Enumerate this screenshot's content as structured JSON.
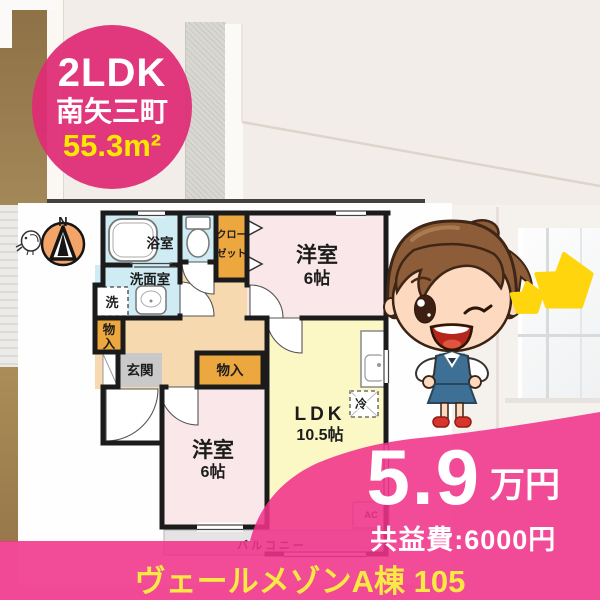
{
  "property": {
    "badge": {
      "layout": "2LDK",
      "town": "南矢三町",
      "area": "55.3m²"
    },
    "price": {
      "rent": "5.9",
      "rent_unit": "万円",
      "common_fee": "共益費:6000円"
    },
    "name": "ヴェールメゾンA棟 105"
  },
  "floorplan": {
    "compass": "N",
    "labels": {
      "bath": "浴室",
      "washroom": "洗面室",
      "washer": "洗",
      "storage_small_1": "物",
      "storage_small_2": "入",
      "closet_1": "クロー",
      "closet_2": "ゼット",
      "bedroom1": "洋室",
      "bedroom1_size": "6帖",
      "bedroom2": "洋室",
      "bedroom2_size": "6帖",
      "ldk": "LDK",
      "ldk_size": "10.5帖",
      "entrance": "玄関",
      "storage": "物入",
      "fridge": "冷",
      "ac": "AC",
      "balcony": "バルコニー"
    }
  },
  "icons": {
    "compass": "compass-north-icon",
    "bird": "chick-doodle-icon",
    "stars": "two-yellow-stars-icon",
    "mascot": "winking-office-lady-illustration"
  },
  "colors": {
    "overlay_pink": "#f0328a",
    "badge_pink": "#df2d76",
    "star_yellow": "#ffd60e",
    "area_yellow": "#ffe800",
    "name_yellow": "#f9e943",
    "bath_blue": "#cfecf4",
    "bedroom_pink": "#f9e7e9",
    "ldk_yellow": "#fcf8c6",
    "hall_peach": "#f6d9af",
    "storage_orange": "#eda73f",
    "entrance_gray": "#c9c9c9",
    "compass_orange": "#f2a469"
  }
}
